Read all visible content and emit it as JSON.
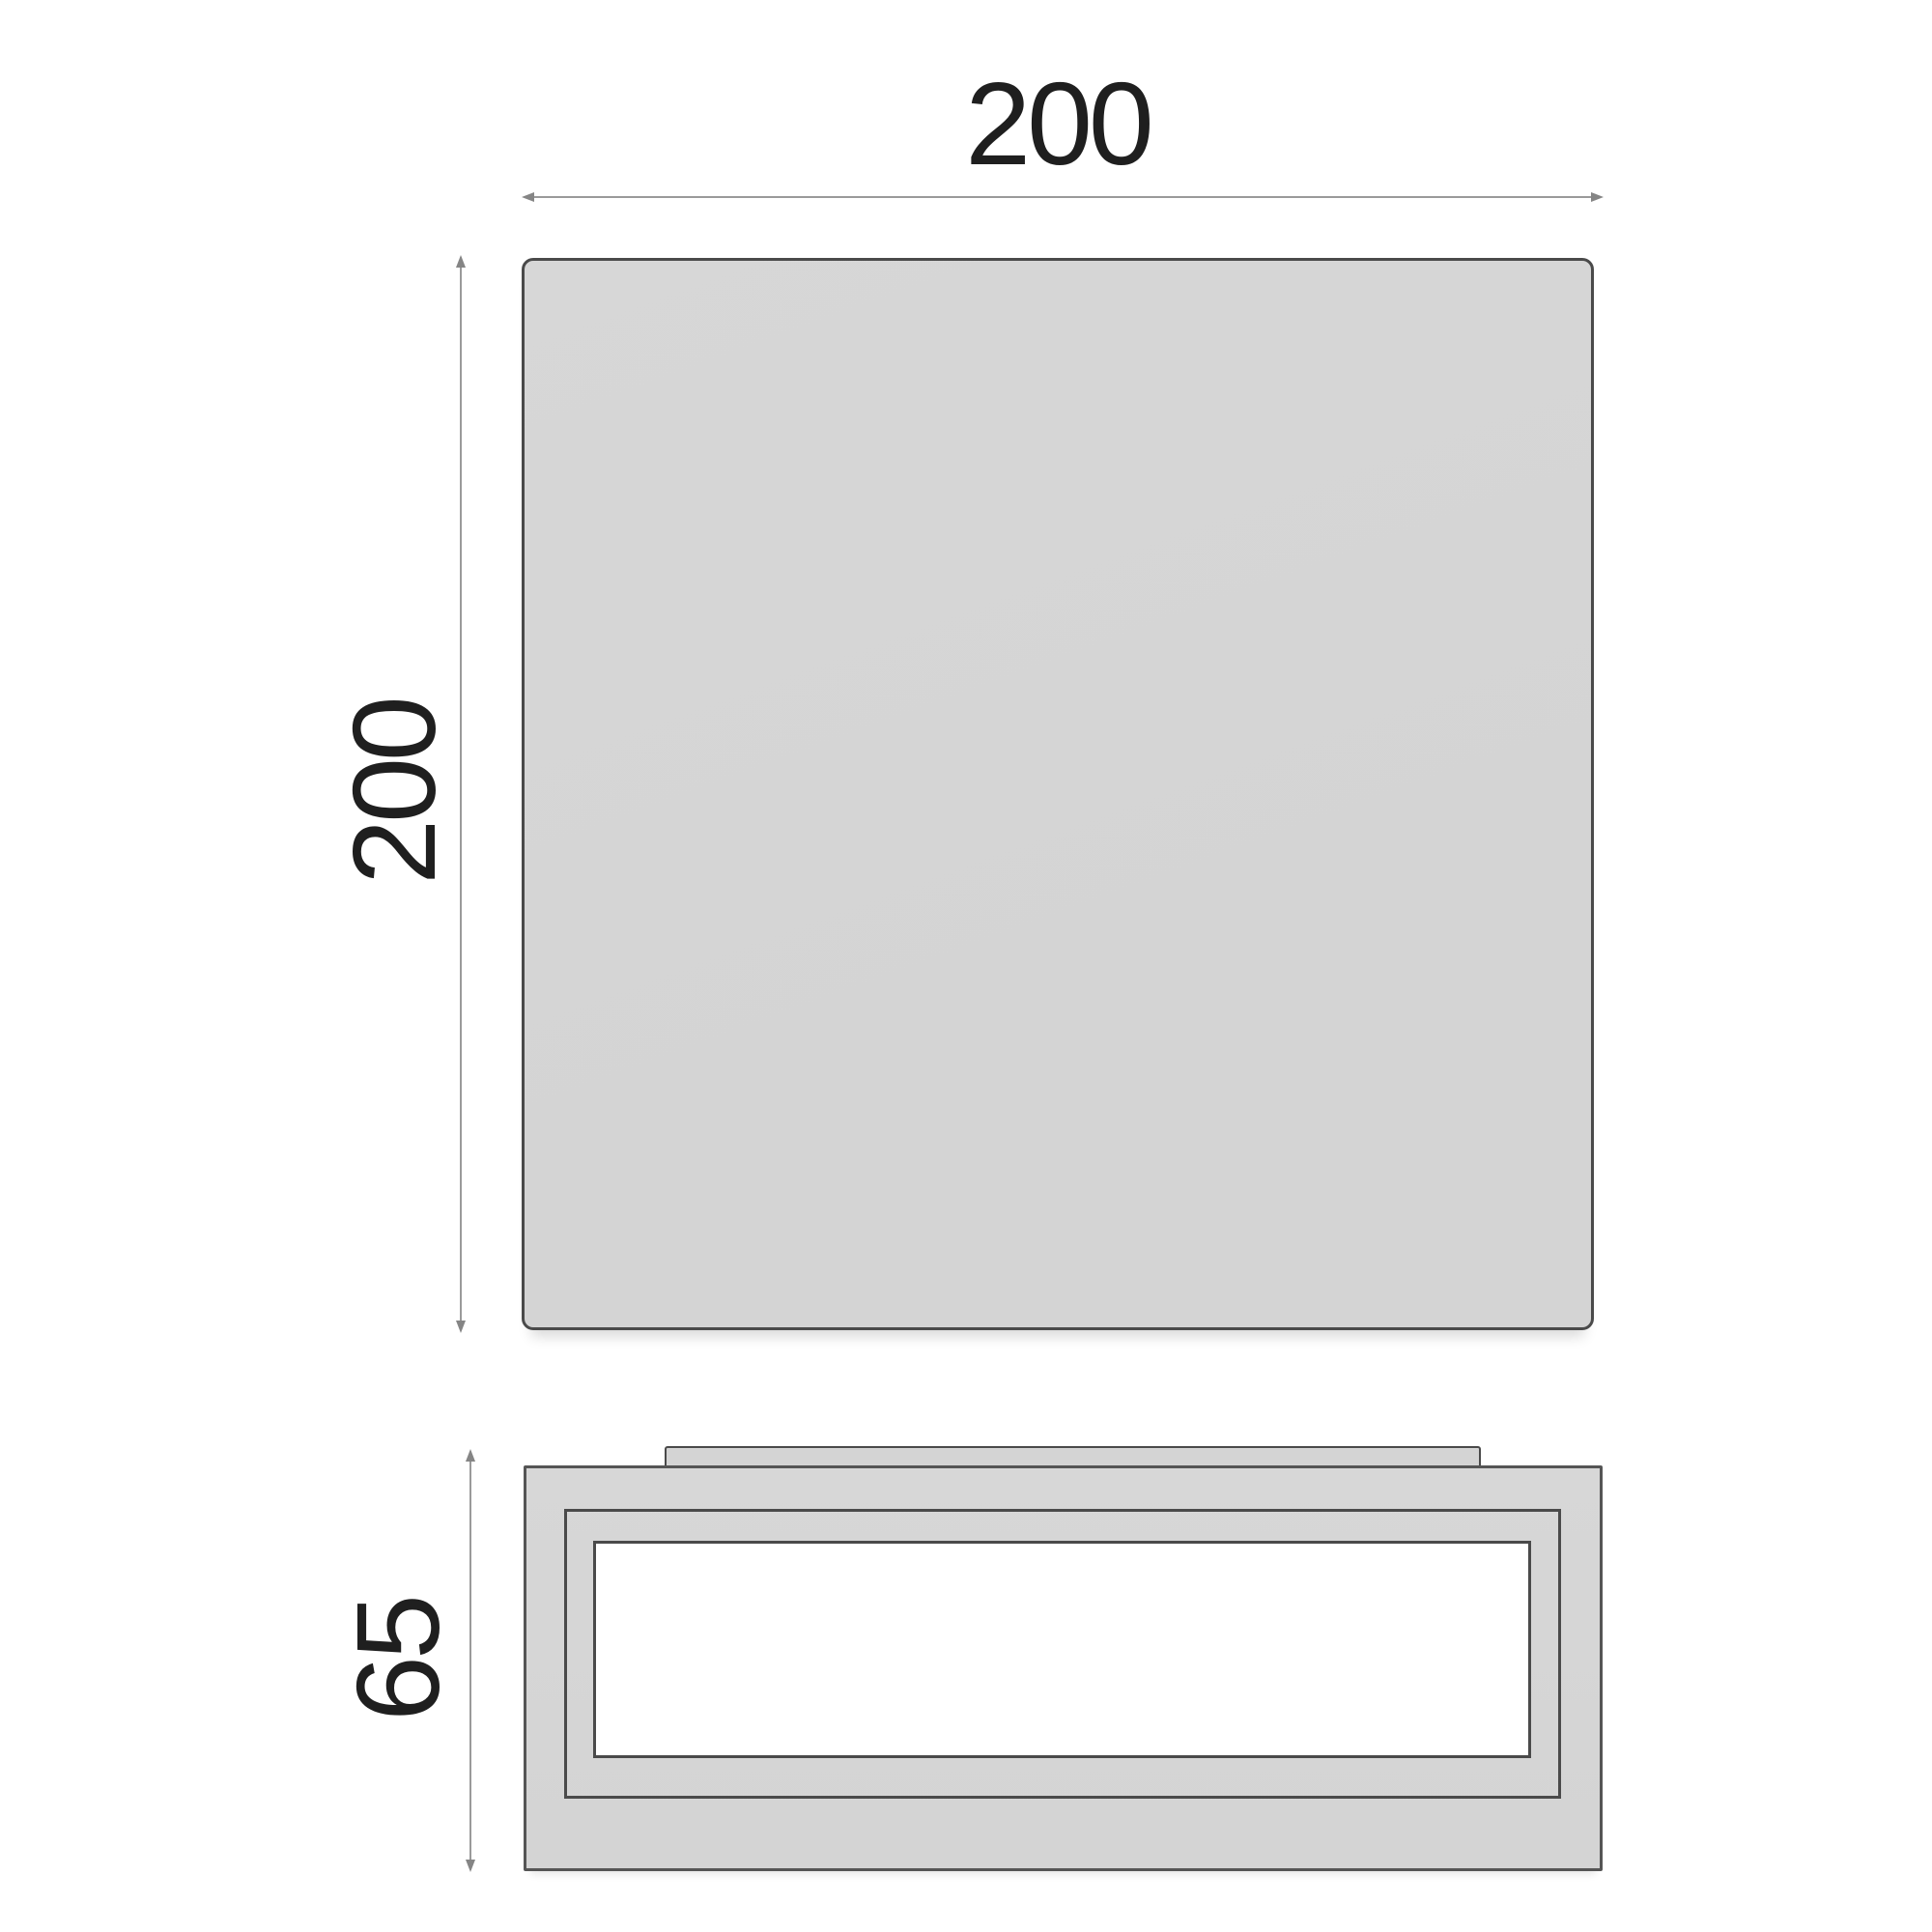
{
  "drawing": {
    "views": {
      "top_view": {
        "width_label": "200",
        "height_label": "200"
      },
      "side_view": {
        "depth_label": "65"
      }
    }
  },
  "colors": {
    "body_fill": "#d4d4d4",
    "body_fill_light": "#d7d7d7",
    "outline": "#4a4a4a",
    "dim_line": "#9a9a9a",
    "dim_arrow": "#858585",
    "label_text": "#1f1f1f",
    "window_fill": "#ffffff",
    "page_bg": "#ffffff"
  }
}
